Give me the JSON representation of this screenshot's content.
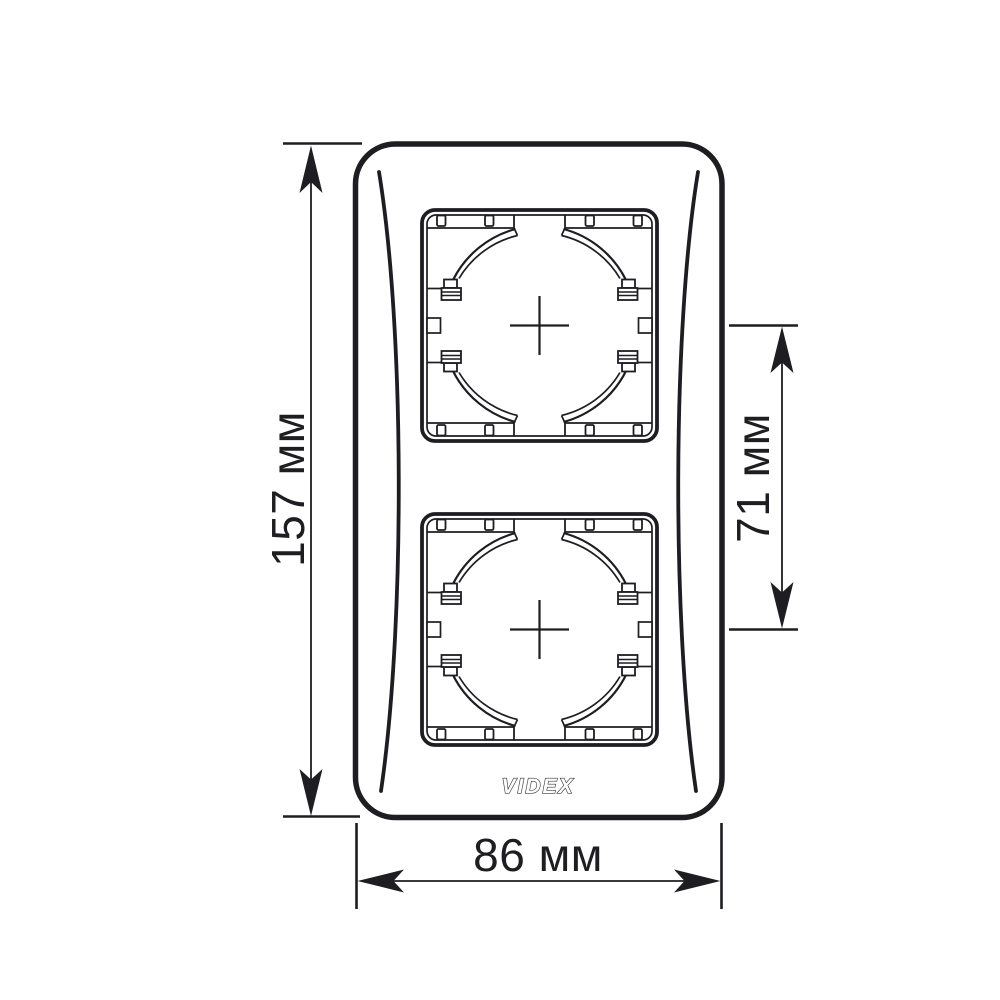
{
  "diagram": {
    "type": "technical-dimension-drawing",
    "dimensions": {
      "height_label": "157 мм",
      "center_spacing_label": "71 мм",
      "width_label": "86 мм"
    },
    "logo_text": "VIDEX",
    "colors": {
      "line": "#1d1d22",
      "background": "#ffffff"
    }
  }
}
